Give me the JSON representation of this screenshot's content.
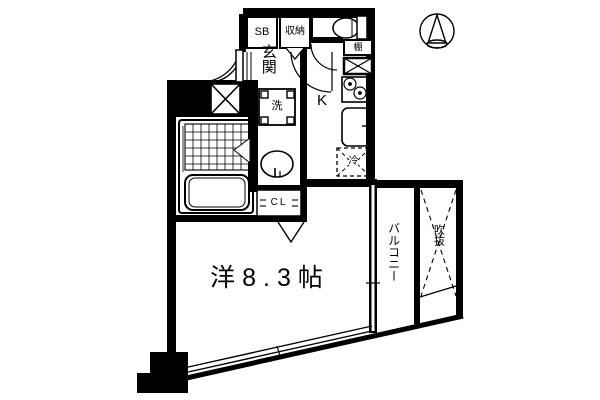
{
  "plan": {
    "rooms": {
      "entrance": "玄関",
      "kitchen": "K",
      "main_room": "洋8.3帖",
      "balcony": "バルコニー",
      "void_space": "吹抜",
      "closet": "CL"
    },
    "fixtures": {
      "shoe_box": "SB",
      "storage": "収納",
      "shelf": "棚",
      "washing_machine": "洗",
      "refrigerator": "冷"
    },
    "icons": {
      "compass": "north-arrow-compass",
      "bath": "bathtub-and-tile-floor",
      "toilet": "toilet-bowl",
      "stove": "two-burner-stove",
      "sink": "wash-basin"
    },
    "colors": {
      "line": "#000000",
      "background": "#ffffff"
    }
  }
}
